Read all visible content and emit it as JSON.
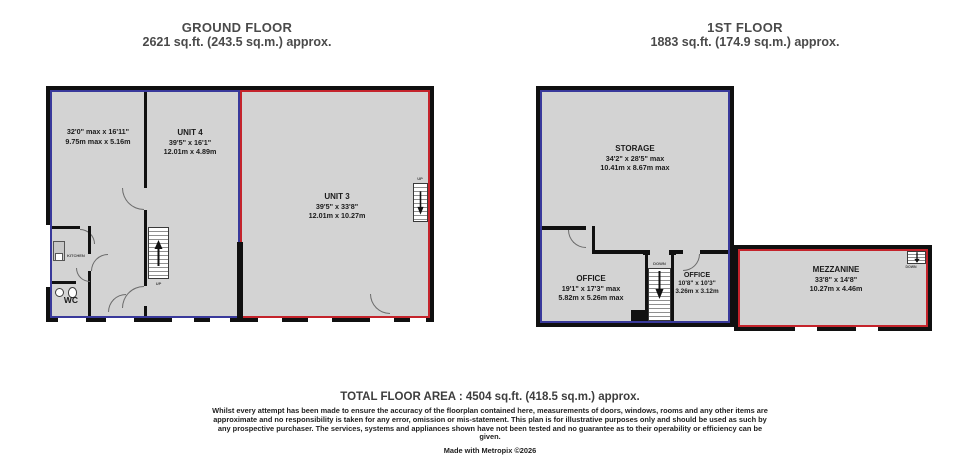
{
  "colors": {
    "blue": "#39399b",
    "red": "#c4232b",
    "floor": "#d3d3d3",
    "wall": "#101010"
  },
  "ground_floor": {
    "title": "GROUND FLOOR",
    "area": "2621 sq.ft. (243.5 sq.m.) approx.",
    "left_room": {
      "dims_imperial": "32'0\" max x 16'11\"",
      "dims_metric": "9.75m max x 5.16m"
    },
    "unit4": {
      "name": "UNIT 4",
      "dims_imperial": "39'5\" x 16'1\"",
      "dims_metric": "12.01m x 4.89m"
    },
    "unit3": {
      "name": "UNIT 3",
      "dims_imperial": "39'5\" x 33'8\"",
      "dims_metric": "12.01m x 10.27m"
    },
    "kitchen_label": "KITCHEN",
    "wc_label": "WC",
    "stairs_up_label": "UP"
  },
  "first_floor": {
    "title": "1ST FLOOR",
    "area": "1883 sq.ft. (174.9 sq.m.) approx.",
    "storage": {
      "name": "STORAGE",
      "dims_imperial": "34'2\" x 28'5\" max",
      "dims_metric": "10.41m x 8.67m max"
    },
    "office_left": {
      "name": "OFFICE",
      "dims_imperial": "19'1\" x 17'3\" max",
      "dims_metric": "5.82m x 5.26m max"
    },
    "office_right": {
      "name": "OFFICE",
      "dims_imperial": "10'8\" x 10'3\"",
      "dims_metric": "3.26m x 3.12m"
    },
    "mezzanine": {
      "name": "MEZZANINE",
      "dims_imperial": "33'8\" x 14'8\"",
      "dims_metric": "10.27m x 4.46m"
    },
    "stairs_down_label": "DOWN"
  },
  "footer": {
    "total_area": "TOTAL FLOOR AREA : 4504 sq.ft. (418.5 sq.m.) approx.",
    "disclaimer": "Whilst every attempt has been made to ensure the accuracy of the floorplan contained here, measurements of doors, windows, rooms and any other items are approximate and no responsibility is taken for any error, omission or mis-statement. This plan is for illustrative purposes only and should be used as such by any prospective purchaser. The services, systems and appliances shown have not been tested and no guarantee as to their operability or efficiency can be given.",
    "credit": "Made with Metropix ©2026"
  }
}
